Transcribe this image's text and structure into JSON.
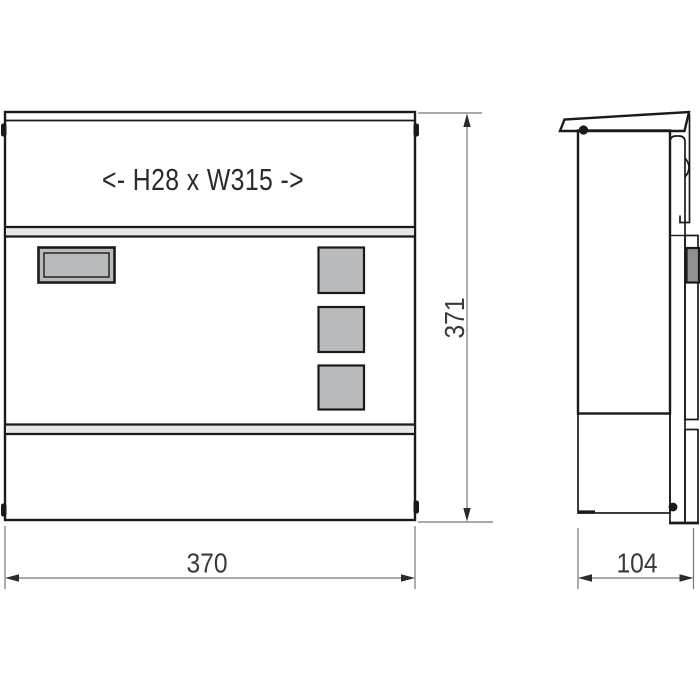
{
  "drawing": {
    "slot_label": "<- H28 x W315 ->",
    "dim_width": "370",
    "dim_height": "371",
    "dim_depth": "104"
  },
  "colors": {
    "background": "#ffffff",
    "body_fill": "#d9dadc",
    "band_fill": "#e6e7e8",
    "panel_fill": "#b8babc",
    "lock_fill": "#8e9092",
    "outline": "#1a1a1a",
    "dim_line": "#757575",
    "arrow": "#2b2b2b",
    "text": "#3a3a3a",
    "slot_text": "#2b2b2b"
  }
}
